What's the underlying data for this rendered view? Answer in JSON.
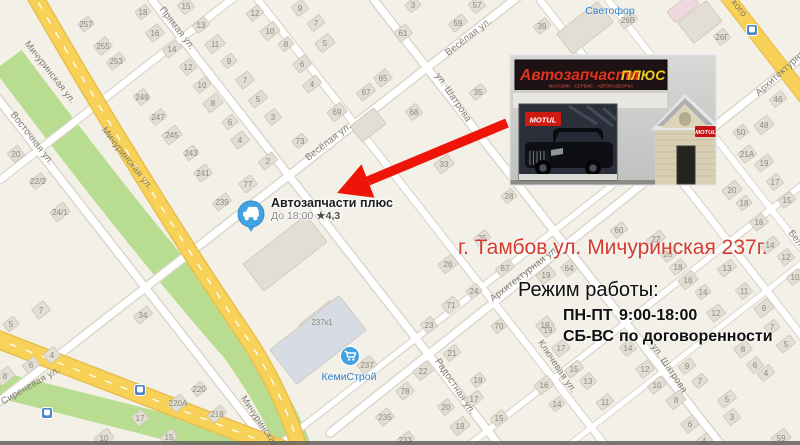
{
  "colors": {
    "map_bg": "#f3f0e8",
    "road_yellow": "#f7d158",
    "road_casing": "#dcd7cc",
    "green": "#b9dd90",
    "arrow_red": "#ee1408",
    "address_red": "#d53c31",
    "poi_blue": "#2f7ec9",
    "marker_blue": "#42a2e2",
    "building_fill": "#e3ded4"
  },
  "map": {
    "street_labels": [
      [
        "Мичуринская ул.",
        48,
        74,
        52
      ],
      [
        "Мичуринская ул.",
        125,
        160,
        52
      ],
      [
        "Мичуринская ул.",
        262,
        430,
        56
      ],
      [
        "Восточная ул.",
        30,
        140,
        52
      ],
      [
        "Прямая ул.",
        175,
        30,
        52
      ],
      [
        "Весёлая ул.",
        330,
        144,
        -38
      ],
      [
        "Весёлая ул.",
        470,
        39,
        -38
      ],
      [
        "ул. Шатрова",
        451,
        99,
        56
      ],
      [
        "ул. Шатрова",
        667,
        370,
        56
      ],
      [
        "Радостная ул.",
        453,
        388,
        56
      ],
      [
        "Ключевая ул.",
        555,
        368,
        56
      ],
      [
        "Сиреневая ул.",
        32,
        388,
        -30
      ],
      [
        "Архитектурная ул.",
        526,
        276,
        -38
      ],
      [
        "Архитектурная ул.",
        790,
        68,
        -42
      ],
      [
        "кого",
        737,
        10,
        52
      ],
      [
        "Бело",
        795,
        242,
        52
      ]
    ],
    "buildings": [
      [
        "257",
        86,
        24
      ],
      [
        "255",
        103,
        46
      ],
      [
        "253",
        116,
        61
      ],
      [
        "249",
        142,
        97
      ],
      [
        "247",
        158,
        117
      ],
      [
        "245",
        172,
        135
      ],
      [
        "243",
        191,
        153
      ],
      [
        "241",
        203,
        173
      ],
      [
        "239",
        222,
        202
      ],
      [
        "20",
        16,
        154
      ],
      [
        "22/2",
        38,
        181
      ],
      [
        "24/1",
        60,
        212
      ],
      [
        "18",
        143,
        12
      ],
      [
        "16",
        155,
        33
      ],
      [
        "14",
        172,
        49
      ],
      [
        "12",
        188,
        67
      ],
      [
        "10",
        202,
        85
      ],
      [
        "8",
        213,
        103
      ],
      [
        "6",
        230,
        122
      ],
      [
        "4",
        240,
        140
      ],
      [
        "2",
        268,
        161
      ],
      [
        "15",
        186,
        6
      ],
      [
        "13",
        201,
        25
      ],
      [
        "11",
        215,
        44
      ],
      [
        "9",
        229,
        61
      ],
      [
        "7",
        245,
        80
      ],
      [
        "5",
        258,
        99
      ],
      [
        "3",
        273,
        117
      ],
      [
        "12",
        255,
        13
      ],
      [
        "10",
        270,
        31
      ],
      [
        "8",
        286,
        44
      ],
      [
        "6",
        302,
        64
      ],
      [
        "4",
        312,
        84
      ],
      [
        "9",
        300,
        8
      ],
      [
        "7",
        316,
        23
      ],
      [
        "5",
        325,
        43
      ],
      [
        "3",
        413,
        5
      ],
      [
        "61",
        403,
        33
      ],
      [
        "59",
        458,
        23
      ],
      [
        "57",
        477,
        5
      ],
      [
        "39",
        542,
        26
      ],
      [
        "69",
        337,
        112
      ],
      [
        "73",
        300,
        141
      ],
      [
        "65",
        383,
        78
      ],
      [
        "67",
        366,
        92
      ],
      [
        "68",
        414,
        112
      ],
      [
        "35",
        478,
        92
      ],
      [
        "33",
        444,
        164
      ],
      [
        "28",
        509,
        196
      ],
      [
        "77",
        248,
        184
      ],
      [
        "26В",
        628,
        20
      ],
      [
        "26Г",
        722,
        37
      ],
      [
        "25",
        482,
        238
      ],
      [
        "26",
        448,
        264
      ],
      [
        "24",
        474,
        291
      ],
      [
        "71",
        451,
        305
      ],
      [
        "67",
        505,
        268
      ],
      [
        "64",
        569,
        268
      ],
      [
        "60",
        619,
        230
      ],
      [
        "19",
        546,
        275
      ],
      [
        "70",
        499,
        326
      ],
      [
        "19",
        545,
        325
      ],
      [
        "22",
        656,
        239
      ],
      [
        "20",
        668,
        254
      ],
      [
        "18",
        678,
        267
      ],
      [
        "16",
        688,
        280
      ],
      [
        "14",
        703,
        292
      ],
      [
        "12",
        716,
        313
      ],
      [
        "13",
        727,
        268
      ],
      [
        "11",
        744,
        291
      ],
      [
        "46",
        778,
        99
      ],
      [
        "48",
        764,
        125
      ],
      [
        "50",
        741,
        132
      ],
      [
        "21А",
        747,
        154
      ],
      [
        "19",
        764,
        163
      ],
      [
        "17",
        775,
        182
      ],
      [
        "15",
        787,
        200
      ],
      [
        "20",
        732,
        190
      ],
      [
        "18",
        744,
        203
      ],
      [
        "16",
        759,
        222
      ],
      [
        "14",
        770,
        245
      ],
      [
        "12",
        786,
        257
      ],
      [
        "10",
        795,
        277
      ],
      [
        "9",
        764,
        308
      ],
      [
        "7",
        772,
        327
      ],
      [
        "8",
        743,
        349
      ],
      [
        "5",
        786,
        344
      ],
      [
        "6",
        755,
        365
      ],
      [
        "4",
        766,
        373
      ],
      [
        "237к1",
        322,
        322,
        40,
        24
      ],
      [
        "237",
        367,
        365,
        16,
        12
      ],
      [
        "235",
        385,
        417
      ],
      [
        "233",
        405,
        440
      ],
      [
        "23",
        429,
        325
      ],
      [
        "21",
        452,
        353
      ],
      [
        "22",
        423,
        371
      ],
      [
        "19",
        478,
        380
      ],
      [
        "78",
        405,
        391
      ],
      [
        "17",
        474,
        399
      ],
      [
        "20",
        446,
        407
      ],
      [
        "15",
        499,
        418
      ],
      [
        "18",
        460,
        426
      ],
      [
        "19",
        548,
        330
      ],
      [
        "17",
        561,
        348
      ],
      [
        "15",
        574,
        369
      ],
      [
        "13",
        588,
        381
      ],
      [
        "11",
        605,
        402
      ],
      [
        "16",
        544,
        385
      ],
      [
        "14",
        557,
        404
      ],
      [
        "12",
        645,
        369
      ],
      [
        "10",
        657,
        385
      ],
      [
        "14",
        628,
        348
      ],
      [
        "9",
        687,
        366
      ],
      [
        "8",
        676,
        400
      ],
      [
        "7",
        700,
        381
      ],
      [
        "6",
        690,
        424
      ],
      [
        "5",
        727,
        399
      ],
      [
        "3",
        732,
        417
      ],
      [
        "4",
        704,
        441
      ],
      [
        "59",
        781,
        438
      ],
      [
        "5",
        11,
        324
      ],
      [
        "7",
        41,
        310
      ],
      [
        "34",
        143,
        315
      ],
      [
        "4",
        52,
        355
      ],
      [
        "6",
        31,
        365
      ],
      [
        "8",
        5,
        376
      ],
      [
        "220",
        199,
        389
      ],
      [
        "220А",
        178,
        403
      ],
      [
        "218",
        217,
        414
      ],
      [
        "17",
        140,
        418
      ],
      [
        "15",
        169,
        437
      ],
      [
        "10",
        104,
        438
      ],
      [
        "",
        585,
        28,
        52,
        26,
        ""
      ],
      [
        "",
        683,
        8,
        30,
        14,
        "pink"
      ],
      [
        "",
        285,
        253,
        80,
        34,
        ""
      ],
      [
        "",
        318,
        340,
        88,
        44,
        "blue"
      ],
      [
        "",
        700,
        22,
        36,
        26,
        ""
      ],
      [
        "",
        368,
        125,
        30,
        20,
        ""
      ]
    ],
    "transit_stops": [
      [
        47,
        413
      ],
      [
        140,
        390
      ],
      [
        752,
        30
      ]
    ],
    "pois": [
      {
        "label": "Светофор",
        "x": 610,
        "y": 11,
        "icon": ""
      },
      {
        "label": "КемиСтрой",
        "x": 349,
        "y": 377,
        "icon": "cart",
        "icon_x": 350,
        "icon_y": 356
      }
    ]
  },
  "marker": {
    "title": "Автозапчасти плюс",
    "hours": "До 18:00",
    "star": "★",
    "rating": "4,3"
  },
  "annotation": {
    "address": "г. Тамбов ул. Мичуринская 237г.",
    "schedule_title": "Режим работы:",
    "schedule": [
      {
        "days": "ПН-ПТ",
        "time": "9:00-18:00"
      },
      {
        "days": "СБ-ВС",
        "time": "по договоренности"
      }
    ]
  },
  "photo": {
    "sign_main": "Автозапчасти",
    "sign_accent": "ПЛЮС",
    "sign_sub": "МАГАЗИН · СЕРВИС · АВТОРАЗБОРКА",
    "brand_banner": "MOTUL",
    "brand_wall": "MOTUL"
  }
}
